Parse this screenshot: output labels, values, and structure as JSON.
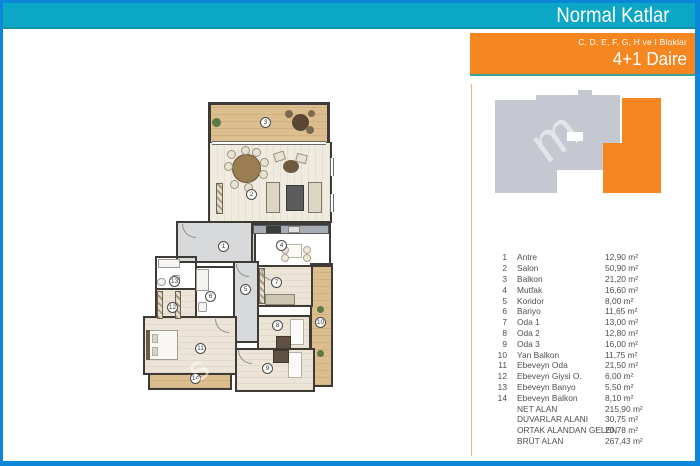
{
  "header": {
    "title": "Normal Katlar"
  },
  "unit_badge": {
    "blocks": "C, D, E, F, G, H ve I Bloklar",
    "unit_type": "4+1 Daire"
  },
  "colors": {
    "frame_blue": "#0b86d8",
    "band_teal": "#0ca6c6",
    "accent_orange": "#f6861f",
    "footprint_gray": "#c5c8d1",
    "footprint_highlight": "#f6861f",
    "list_text": "#4e4f51"
  },
  "floorplan": {
    "markers": [
      "1",
      "2",
      "3",
      "4",
      "5",
      "6",
      "7",
      "8",
      "9",
      "10",
      "11",
      "12",
      "13",
      "14"
    ]
  },
  "watermark": {
    "plan_glyph": "s",
    "footprint_glyph": "m"
  },
  "room_list": {
    "rooms": [
      {
        "no": "1",
        "name": "Antre",
        "area": "12,90 m²"
      },
      {
        "no": "2",
        "name": "Salon",
        "area": "50,90 m²"
      },
      {
        "no": "3",
        "name": "Balkon",
        "area": "21,20 m²"
      },
      {
        "no": "4",
        "name": "Mutfak",
        "area": "16,60 m²"
      },
      {
        "no": "5",
        "name": "Koridor",
        "area": "8,00 m²"
      },
      {
        "no": "6",
        "name": "Banyo",
        "area": "11,65 m²"
      },
      {
        "no": "7",
        "name": "Oda 1",
        "area": "13,00 m²"
      },
      {
        "no": "8",
        "name": "Oda 2",
        "area": "12,80 m²"
      },
      {
        "no": "9",
        "name": "Oda 3",
        "area": "16,00 m²"
      },
      {
        "no": "10",
        "name": "Yan Balkon",
        "area": "11,75 m²"
      },
      {
        "no": "11",
        "name": "Ebeveyn Oda",
        "area": "21,50 m²"
      },
      {
        "no": "12",
        "name": "Ebeveyn Giysi O.",
        "area": "6,00 m²"
      },
      {
        "no": "13",
        "name": "Ebeveyn Banyo",
        "area": "5,50 m²"
      },
      {
        "no": "14",
        "name": "Ebeveyn Balkon",
        "area": "8,10 m²"
      }
    ],
    "summary": [
      {
        "label": "NET ALAN",
        "area": "215,90 m²"
      },
      {
        "label": "DUVARLAR ALANI",
        "area": "30,75 m²"
      },
      {
        "label": "ORTAK ALANDAN GELEN",
        "area": "20,78 m²"
      },
      {
        "label": "BRÜT ALAN",
        "area": "267,43 m²"
      }
    ]
  }
}
